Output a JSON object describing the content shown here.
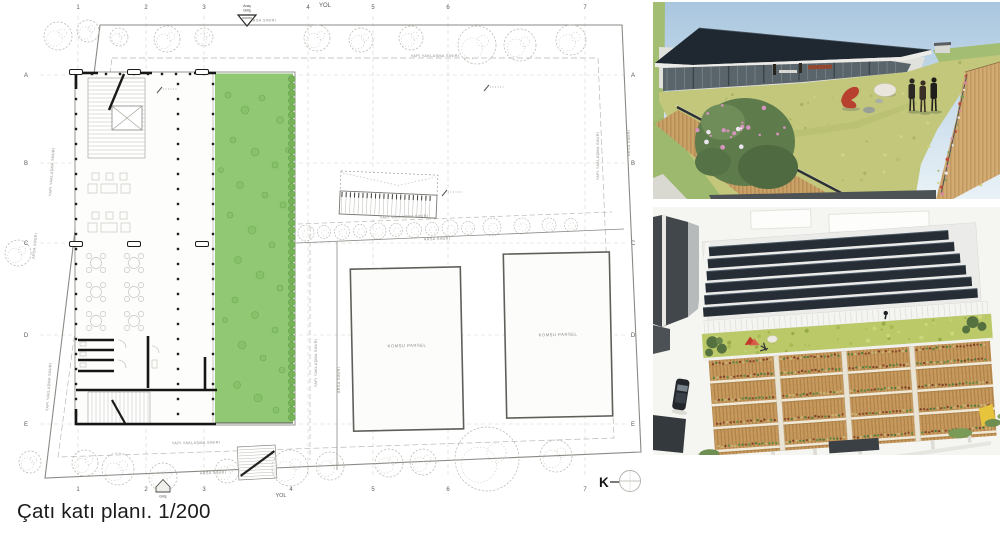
{
  "caption": "Çatı katı planı. 1/200",
  "plan": {
    "road_label_top": "YOL",
    "road_label_bottom": "YOL",
    "north_label": "K",
    "entry_label": "Giriş",
    "parcel_label": "KOMŞU PARSEL",
    "vehicle_entry": {
      "line1": "Araç",
      "line2": "Giriş"
    },
    "grid_columns": [
      {
        "label": "1",
        "x": 78
      },
      {
        "label": "2",
        "x": 146
      },
      {
        "label": "3",
        "x": 204
      },
      {
        "label": "4",
        "x": 308,
        "bx": 291
      },
      {
        "label": "5",
        "x": 373
      },
      {
        "label": "6",
        "x": 448
      },
      {
        "label": "7",
        "x": 585
      }
    ],
    "grid_rows": [
      {
        "label": "A",
        "y": 75
      },
      {
        "label": "B",
        "y": 163
      },
      {
        "label": "C",
        "y": 243
      },
      {
        "label": "D",
        "y": 335
      },
      {
        "label": "E",
        "y": 424
      }
    ],
    "boundary_labels": [
      {
        "text": "ARSA SINIRI",
        "x": 263,
        "y": 21.5,
        "r": 0
      },
      {
        "text": "YAPI YAKLAŞMA SINIRI",
        "x": 435,
        "y": 57,
        "r": 0
      },
      {
        "text": "YAPI YAKLAŞMA SINIRI",
        "x": 53,
        "y": 172,
        "r": -86
      },
      {
        "text": "YAPI YAKLAŞMA SINIRI",
        "x": 50,
        "y": 387,
        "r": -86
      },
      {
        "text": "ARSA SINIRI",
        "x": 36,
        "y": 246,
        "r": -84
      },
      {
        "text": "ARSA SINIRI",
        "x": 630,
        "y": 143,
        "r": -90
      },
      {
        "text": "YAPI YAKLAŞMA SINIRI",
        "x": 599,
        "y": 156,
        "r": -90
      },
      {
        "text": "YAPI YAKLAŞMA SINIRI",
        "x": 196,
        "y": 444,
        "r": -1
      },
      {
        "text": "ARSA SINIRI",
        "x": 213,
        "y": 474,
        "r": -2
      },
      {
        "text": "YAPI YAKLAŞMA SINIRI",
        "x": 317,
        "y": 363,
        "r": -90
      },
      {
        "text": "ARSA SINIRI",
        "x": 340,
        "y": 380,
        "r": -90
      },
      {
        "text": "YAPI YAKLAŞMA SINIRI",
        "x": 404,
        "y": 218,
        "r": -2
      },
      {
        "text": "ARSA SINIRI",
        "x": 437,
        "y": 240,
        "r": -2
      }
    ],
    "trees": [
      [
        58,
        36,
        14
      ],
      [
        88,
        31,
        11
      ],
      [
        119,
        37,
        9
      ],
      [
        167,
        39,
        13
      ],
      [
        204,
        37,
        9
      ],
      [
        317,
        38,
        13
      ],
      [
        361,
        40,
        12
      ],
      [
        411,
        38,
        12
      ],
      [
        477,
        45,
        19
      ],
      [
        520,
        45,
        16
      ],
      [
        571,
        40,
        15
      ],
      [
        18,
        253,
        13
      ],
      [
        30,
        462,
        11
      ],
      [
        85,
        463,
        13
      ],
      [
        118,
        469,
        16
      ],
      [
        163,
        477,
        14
      ],
      [
        227,
        471,
        12
      ],
      [
        290,
        468,
        18
      ],
      [
        330,
        466,
        14
      ],
      [
        389,
        463,
        14
      ],
      [
        423,
        462,
        13
      ],
      [
        487,
        459,
        32
      ],
      [
        556,
        456,
        16
      ]
    ],
    "bushes_mid": [
      [
        306,
        233,
        8
      ],
      [
        324,
        232,
        6.5
      ],
      [
        342,
        232,
        7.5
      ],
      [
        360,
        231,
        6.5
      ],
      [
        378,
        231,
        8
      ],
      [
        396,
        230,
        6.5
      ],
      [
        414,
        230,
        7.5
      ],
      [
        432,
        229,
        6.5
      ],
      [
        450,
        228,
        8
      ],
      [
        468,
        228,
        6.5
      ],
      [
        492,
        227,
        9
      ],
      [
        522,
        226,
        8
      ],
      [
        549,
        225,
        7
      ],
      [
        571,
        225,
        6.5
      ]
    ],
    "green_dots": [
      [
        228,
        95,
        3
      ],
      [
        245,
        110,
        4
      ],
      [
        262,
        98,
        3
      ],
      [
        280,
        120,
        3.5
      ],
      [
        233,
        140,
        3
      ],
      [
        255,
        152,
        4
      ],
      [
        275,
        165,
        3
      ],
      [
        240,
        185,
        3.5
      ],
      [
        265,
        195,
        3
      ],
      [
        283,
        205,
        3
      ],
      [
        230,
        215,
        3
      ],
      [
        252,
        230,
        4
      ],
      [
        272,
        245,
        3
      ],
      [
        238,
        260,
        3.5
      ],
      [
        260,
        275,
        4
      ],
      [
        280,
        288,
        3
      ],
      [
        235,
        300,
        3
      ],
      [
        255,
        315,
        3.5
      ],
      [
        275,
        330,
        3
      ],
      [
        242,
        345,
        4
      ],
      [
        263,
        358,
        3
      ],
      [
        282,
        370,
        3
      ],
      [
        237,
        385,
        3.5
      ],
      [
        258,
        398,
        4
      ],
      [
        276,
        410,
        3
      ],
      [
        225,
        320,
        2.5
      ],
      [
        288,
        150,
        2.5
      ],
      [
        221,
        170,
        2.5
      ]
    ],
    "colors": {
      "plan_green": "#90c873",
      "plan_green_dot": "#6faa52",
      "plan_green_edge": "#5f9e47",
      "boundary_gray": "#8a8a85",
      "wall_black": "#161616"
    }
  },
  "renders": {
    "colors": {
      "sky_top": "#a9c6df",
      "sky_bottom": "#e9f2f7",
      "field_green": "#a3bd72",
      "grass_roof": "#c2c77b",
      "wood": "#c9a268",
      "solar_panel": "#262d34",
      "green_roof": "#bcc968",
      "facade_wood": "#c89a5e"
    }
  }
}
